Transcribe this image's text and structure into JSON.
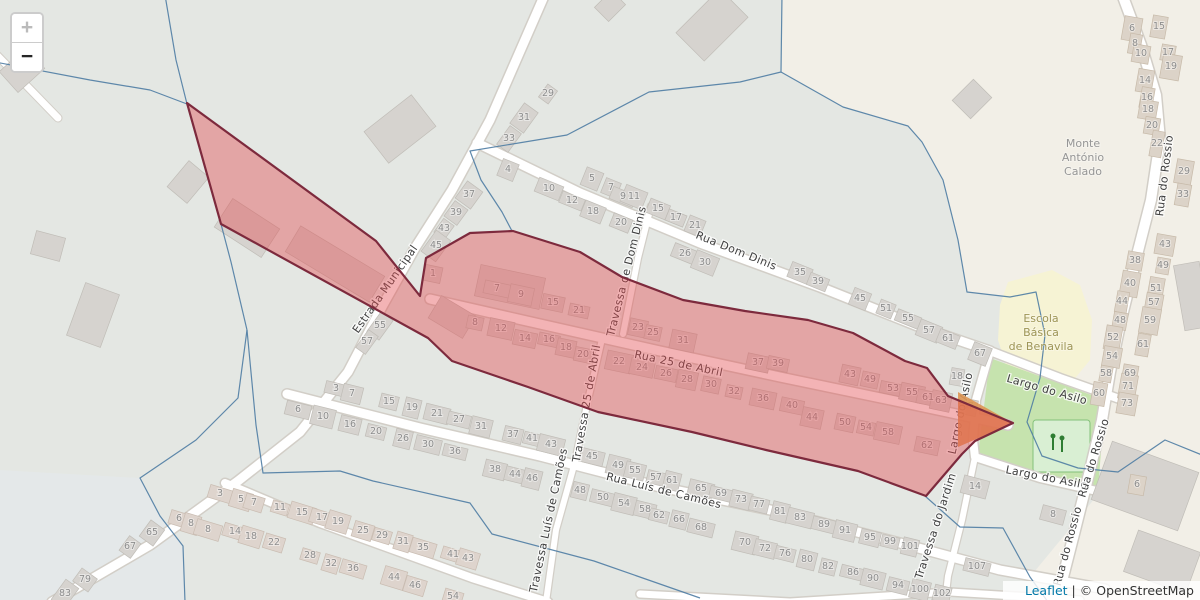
{
  "controls": {
    "zoom_in_label": "+",
    "zoom_out_label": "−"
  },
  "attribution": {
    "leaflet_label": "Leaflet",
    "separator": "|",
    "osm_label": "© OpenStreetMap"
  },
  "map": {
    "colors": {
      "overlay_fill": "#e3494f",
      "overlay_stroke": "#7d2a3d",
      "boundary_line": "#4e7ca3",
      "land_gray": "#e4e7e3",
      "land_base": "#f2efe7",
      "village_green": "#c6e3ae",
      "school_yellow": "#f6f3d4",
      "building_gray": "#d6d3cf",
      "playground_green": "#d9efd3",
      "leaflet_link_blue": "#0078A8"
    },
    "overlay": {
      "points": "187,103 376,241 420,296 426,258 470,233 513,231 580,252 622,277 683,300 745,311 808,320 853,333 905,361 927,368 948,396 1013,423 975,441 962,454 926,496 858,471 766,450 692,432 598,412 528,387 452,361 428,338 221,224",
      "fill": "#e3494f",
      "fill_opacity": 0.42,
      "stroke": "#7d2a3d",
      "stroke_width": 2.2
    },
    "area_labels": [
      {
        "lines": [
          "Monte",
          "António",
          "Calado"
        ],
        "x": 1083,
        "y": 147,
        "color": "#969696"
      },
      {
        "lines": [
          "Escola",
          "Básica",
          "de Benavila"
        ],
        "x": 1041,
        "y": 322,
        "color": "#9d9556"
      }
    ],
    "street_labels": [
      {
        "text": "Estrada Municipal",
        "x": 388,
        "y": 291,
        "angle": -55
      },
      {
        "text": "Rua Dom Dinis",
        "x": 735,
        "y": 254,
        "angle": 22
      },
      {
        "text": "Travessa de Dom Dinis",
        "x": 630,
        "y": 272,
        "angle": -76
      },
      {
        "text": "Rua 25 de Abril",
        "x": 678,
        "y": 367,
        "angle": 12
      },
      {
        "text": "Travessa 25 de Abril",
        "x": 590,
        "y": 404,
        "angle": -80
      },
      {
        "text": "Rua Luís de Camões",
        "x": 663,
        "y": 494,
        "angle": 14
      },
      {
        "text": "Travessa Luís de Camões",
        "x": 552,
        "y": 521,
        "angle": -78
      },
      {
        "text": "Travessa do Jardim",
        "x": 939,
        "y": 527,
        "angle": -72
      },
      {
        "text": "Largo do Asilo",
        "x": 1046,
        "y": 393,
        "angle": 16
      },
      {
        "text": "Largo do Asilo",
        "x": 1046,
        "y": 481,
        "angle": 11
      },
      {
        "text": "Largo do Asilo",
        "x": 964,
        "y": 414,
        "angle": -78
      },
      {
        "text": "Rua do Rossio",
        "x": 1168,
        "y": 176,
        "angle": -83
      },
      {
        "text": "Rua do Rossio",
        "x": 1097,
        "y": 459,
        "angle": -73
      },
      {
        "text": "Rua do Rossio",
        "x": 1071,
        "y": 547,
        "angle": -75
      }
    ],
    "groups": {
      "em": -54,
      "bl": 17,
      "dd": 22,
      "ab": 12,
      "lc": 14,
      "ro": -80,
      "v": -80,
      "la": 15
    },
    "house_numbers": [
      [
        "29",
        548,
        93,
        "em"
      ],
      [
        "31",
        524,
        117,
        "em"
      ],
      [
        "33",
        509,
        138,
        "em"
      ],
      [
        "37",
        469,
        194,
        "em"
      ],
      [
        "39",
        456,
        212,
        "em"
      ],
      [
        "43",
        444,
        228,
        "em"
      ],
      [
        "45",
        436,
        245,
        "em"
      ],
      [
        "55",
        380,
        325,
        "em"
      ],
      [
        "57",
        367,
        341,
        "em"
      ],
      [
        "65",
        152,
        532,
        "em"
      ],
      [
        "67",
        130,
        546,
        "em"
      ],
      [
        "79",
        85,
        579,
        "em"
      ],
      [
        "83",
        65,
        593,
        "em"
      ],
      [
        "3",
        220,
        493,
        "bl"
      ],
      [
        "5",
        241,
        499,
        "bl"
      ],
      [
        "7",
        254,
        502,
        "bl"
      ],
      [
        "11",
        280,
        507,
        "bl"
      ],
      [
        "15",
        302,
        512,
        "bl"
      ],
      [
        "17",
        322,
        517,
        "bl"
      ],
      [
        "19",
        338,
        521,
        "bl"
      ],
      [
        "25",
        363,
        530,
        "bl"
      ],
      [
        "29",
        382,
        535,
        "bl"
      ],
      [
        "31",
        403,
        541,
        "bl"
      ],
      [
        "35",
        423,
        547,
        "bl"
      ],
      [
        "41",
        453,
        554,
        "bl"
      ],
      [
        "43",
        468,
        558,
        "bl"
      ],
      [
        "6",
        179,
        518,
        "bl"
      ],
      [
        "8",
        191,
        523,
        "bl"
      ],
      [
        "8",
        208,
        529,
        "bl"
      ],
      [
        "14",
        235,
        531,
        "bl"
      ],
      [
        "18",
        251,
        536,
        "bl"
      ],
      [
        "22",
        274,
        542,
        "bl"
      ],
      [
        "28",
        310,
        555,
        "bl"
      ],
      [
        "32",
        331,
        563,
        "bl"
      ],
      [
        "36",
        353,
        568,
        "bl"
      ],
      [
        "44",
        394,
        577,
        "bl"
      ],
      [
        "46",
        415,
        585,
        "bl"
      ],
      [
        "54",
        453,
        596,
        "bl"
      ],
      [
        "4",
        508,
        169,
        "dd"
      ],
      [
        "10",
        549,
        188,
        "dd"
      ],
      [
        "12",
        572,
        200,
        "dd"
      ],
      [
        "18",
        593,
        211,
        "dd"
      ],
      [
        "20",
        621,
        222,
        "dd"
      ],
      [
        "5",
        592,
        178,
        "dd"
      ],
      [
        "7",
        611,
        187,
        "dd"
      ],
      [
        "9",
        623,
        196,
        "dd"
      ],
      [
        "11",
        634,
        196,
        "dd"
      ],
      [
        "15",
        658,
        208,
        "dd"
      ],
      [
        "17",
        676,
        217,
        "dd"
      ],
      [
        "21",
        695,
        225,
        "dd"
      ],
      [
        "26",
        685,
        253,
        "dd"
      ],
      [
        "30",
        705,
        262,
        "dd"
      ],
      [
        "35",
        800,
        272,
        "dd"
      ],
      [
        "39",
        818,
        281,
        "dd"
      ],
      [
        "45",
        860,
        298,
        "dd"
      ],
      [
        "51",
        886,
        308,
        "dd"
      ],
      [
        "55",
        908,
        318,
        "dd"
      ],
      [
        "57",
        929,
        330,
        "dd"
      ],
      [
        "61",
        948,
        338,
        "dd"
      ],
      [
        "67",
        980,
        353,
        "dd"
      ],
      [
        "1",
        433,
        273,
        "ab"
      ],
      [
        "7",
        497,
        288,
        "ab"
      ],
      [
        "9",
        521,
        294,
        "ab"
      ],
      [
        "15",
        553,
        302,
        "ab"
      ],
      [
        "21",
        579,
        310,
        "ab"
      ],
      [
        "23",
        638,
        327,
        "ab"
      ],
      [
        "25",
        653,
        332,
        "ab"
      ],
      [
        "31",
        683,
        340,
        "ab"
      ],
      [
        "37",
        758,
        362,
        "ab"
      ],
      [
        "39",
        778,
        363,
        "ab"
      ],
      [
        "43",
        850,
        374,
        "ab"
      ],
      [
        "49",
        870,
        379,
        "ab"
      ],
      [
        "53",
        893,
        388,
        "ab"
      ],
      [
        "55",
        912,
        392,
        "ab"
      ],
      [
        "61",
        928,
        397,
        "ab"
      ],
      [
        "63",
        941,
        400,
        "ab"
      ],
      [
        "67",
        968,
        406,
        "ab"
      ],
      [
        "8",
        475,
        322,
        "ab"
      ],
      [
        "12",
        501,
        328,
        "ab"
      ],
      [
        "14",
        525,
        338,
        "ab"
      ],
      [
        "16",
        549,
        339,
        "ab"
      ],
      [
        "18",
        566,
        347,
        "ab"
      ],
      [
        "20",
        583,
        354,
        "ab"
      ],
      [
        "22",
        619,
        361,
        "ab"
      ],
      [
        "24",
        642,
        367,
        "ab"
      ],
      [
        "26",
        666,
        373,
        "ab"
      ],
      [
        "28",
        687,
        379,
        "ab"
      ],
      [
        "30",
        711,
        384,
        "ab"
      ],
      [
        "32",
        734,
        391,
        "ab"
      ],
      [
        "36",
        763,
        398,
        "ab"
      ],
      [
        "40",
        792,
        405,
        "ab"
      ],
      [
        "44",
        812,
        417,
        "ab"
      ],
      [
        "50",
        845,
        422,
        "ab"
      ],
      [
        "54",
        866,
        427,
        "ab"
      ],
      [
        "58",
        888,
        432,
        "ab"
      ],
      [
        "62",
        927,
        445,
        "ab"
      ],
      [
        "3",
        336,
        388,
        "lc"
      ],
      [
        "7",
        352,
        393,
        "lc"
      ],
      [
        "15",
        389,
        401,
        "lc"
      ],
      [
        "19",
        412,
        407,
        "lc"
      ],
      [
        "21",
        437,
        413,
        "lc"
      ],
      [
        "27",
        459,
        419,
        "lc"
      ],
      [
        "31",
        481,
        426,
        "lc"
      ],
      [
        "37",
        513,
        434,
        "lc"
      ],
      [
        "41",
        532,
        438,
        "lc"
      ],
      [
        "43",
        551,
        444,
        "lc"
      ],
      [
        "45",
        592,
        456,
        "lc"
      ],
      [
        "49",
        618,
        465,
        "lc"
      ],
      [
        "55",
        635,
        470,
        "lc"
      ],
      [
        "57",
        656,
        477,
        "lc"
      ],
      [
        "61",
        672,
        480,
        "lc"
      ],
      [
        "65",
        701,
        488,
        "lc"
      ],
      [
        "69",
        721,
        493,
        "lc"
      ],
      [
        "73",
        741,
        499,
        "lc"
      ],
      [
        "77",
        759,
        504,
        "lc"
      ],
      [
        "81",
        780,
        511,
        "lc"
      ],
      [
        "83",
        800,
        517,
        "lc"
      ],
      [
        "89",
        824,
        524,
        "lc"
      ],
      [
        "91",
        845,
        530,
        "lc"
      ],
      [
        "95",
        870,
        537,
        "lc"
      ],
      [
        "99",
        890,
        541,
        "lc"
      ],
      [
        "101",
        910,
        546,
        "lc"
      ],
      [
        "6",
        298,
        409,
        "lc"
      ],
      [
        "10",
        323,
        416,
        "lc"
      ],
      [
        "16",
        350,
        424,
        "lc"
      ],
      [
        "20",
        376,
        431,
        "lc"
      ],
      [
        "26",
        403,
        438,
        "lc"
      ],
      [
        "30",
        428,
        444,
        "lc"
      ],
      [
        "36",
        455,
        451,
        "lc"
      ],
      [
        "38",
        495,
        469,
        "lc"
      ],
      [
        "44",
        515,
        474,
        "lc"
      ],
      [
        "46",
        532,
        478,
        "lc"
      ],
      [
        "48",
        580,
        490,
        "lc"
      ],
      [
        "50",
        603,
        497,
        "lc"
      ],
      [
        "54",
        624,
        503,
        "lc"
      ],
      [
        "58",
        645,
        509,
        "lc"
      ],
      [
        "62",
        659,
        515,
        "lc"
      ],
      [
        "66",
        679,
        519,
        "lc"
      ],
      [
        "68",
        701,
        527,
        "lc"
      ],
      [
        "70",
        745,
        542,
        "lc"
      ],
      [
        "72",
        765,
        548,
        "lc"
      ],
      [
        "76",
        785,
        553,
        "lc"
      ],
      [
        "80",
        807,
        559,
        "lc"
      ],
      [
        "82",
        828,
        566,
        "lc"
      ],
      [
        "86",
        853,
        572,
        "lc"
      ],
      [
        "90",
        873,
        578,
        "lc"
      ],
      [
        "94",
        898,
        585,
        "lc"
      ],
      [
        "100",
        920,
        589,
        "lc"
      ],
      [
        "102",
        942,
        593,
        "lc"
      ],
      [
        "107",
        977,
        566,
        "lc"
      ],
      [
        "6",
        1132,
        28,
        "ro"
      ],
      [
        "15",
        1159,
        26,
        "ro"
      ],
      [
        "8",
        1135,
        43,
        "ro"
      ],
      [
        "10",
        1141,
        53,
        "ro"
      ],
      [
        "17",
        1168,
        52,
        "ro"
      ],
      [
        "19",
        1171,
        66,
        "ro"
      ],
      [
        "14",
        1145,
        80,
        "ro"
      ],
      [
        "16",
        1147,
        97,
        "ro"
      ],
      [
        "18",
        1148,
        109,
        "ro"
      ],
      [
        "20",
        1152,
        125,
        "ro"
      ],
      [
        "22",
        1157,
        143,
        "ro"
      ],
      [
        "29",
        1184,
        171,
        "ro"
      ],
      [
        "33",
        1183,
        194,
        "ro"
      ],
      [
        "43",
        1165,
        244,
        "ro"
      ],
      [
        "38",
        1135,
        260,
        "ro"
      ],
      [
        "49",
        1163,
        265,
        "ro"
      ],
      [
        "40",
        1130,
        283,
        "ro"
      ],
      [
        "51",
        1156,
        288,
        "ro"
      ],
      [
        "44",
        1122,
        301,
        "ro"
      ],
      [
        "57",
        1154,
        302,
        "ro"
      ],
      [
        "48",
        1120,
        320,
        "ro"
      ],
      [
        "59",
        1150,
        320,
        "ro"
      ],
      [
        "52",
        1113,
        337,
        "ro"
      ],
      [
        "61",
        1143,
        344,
        "ro"
      ],
      [
        "54",
        1112,
        356,
        "ro"
      ],
      [
        "69",
        1130,
        373,
        "ro"
      ],
      [
        "58",
        1106,
        373,
        "ro"
      ],
      [
        "71",
        1128,
        386,
        "ro"
      ],
      [
        "60",
        1099,
        393,
        "ro"
      ],
      [
        "73",
        1127,
        403,
        "ro"
      ],
      [
        "6",
        1137,
        484,
        "ro"
      ],
      [
        "18",
        957,
        376,
        "v"
      ],
      [
        "14",
        975,
        486,
        "la"
      ],
      [
        "8",
        1053,
        514,
        "la"
      ]
    ]
  }
}
